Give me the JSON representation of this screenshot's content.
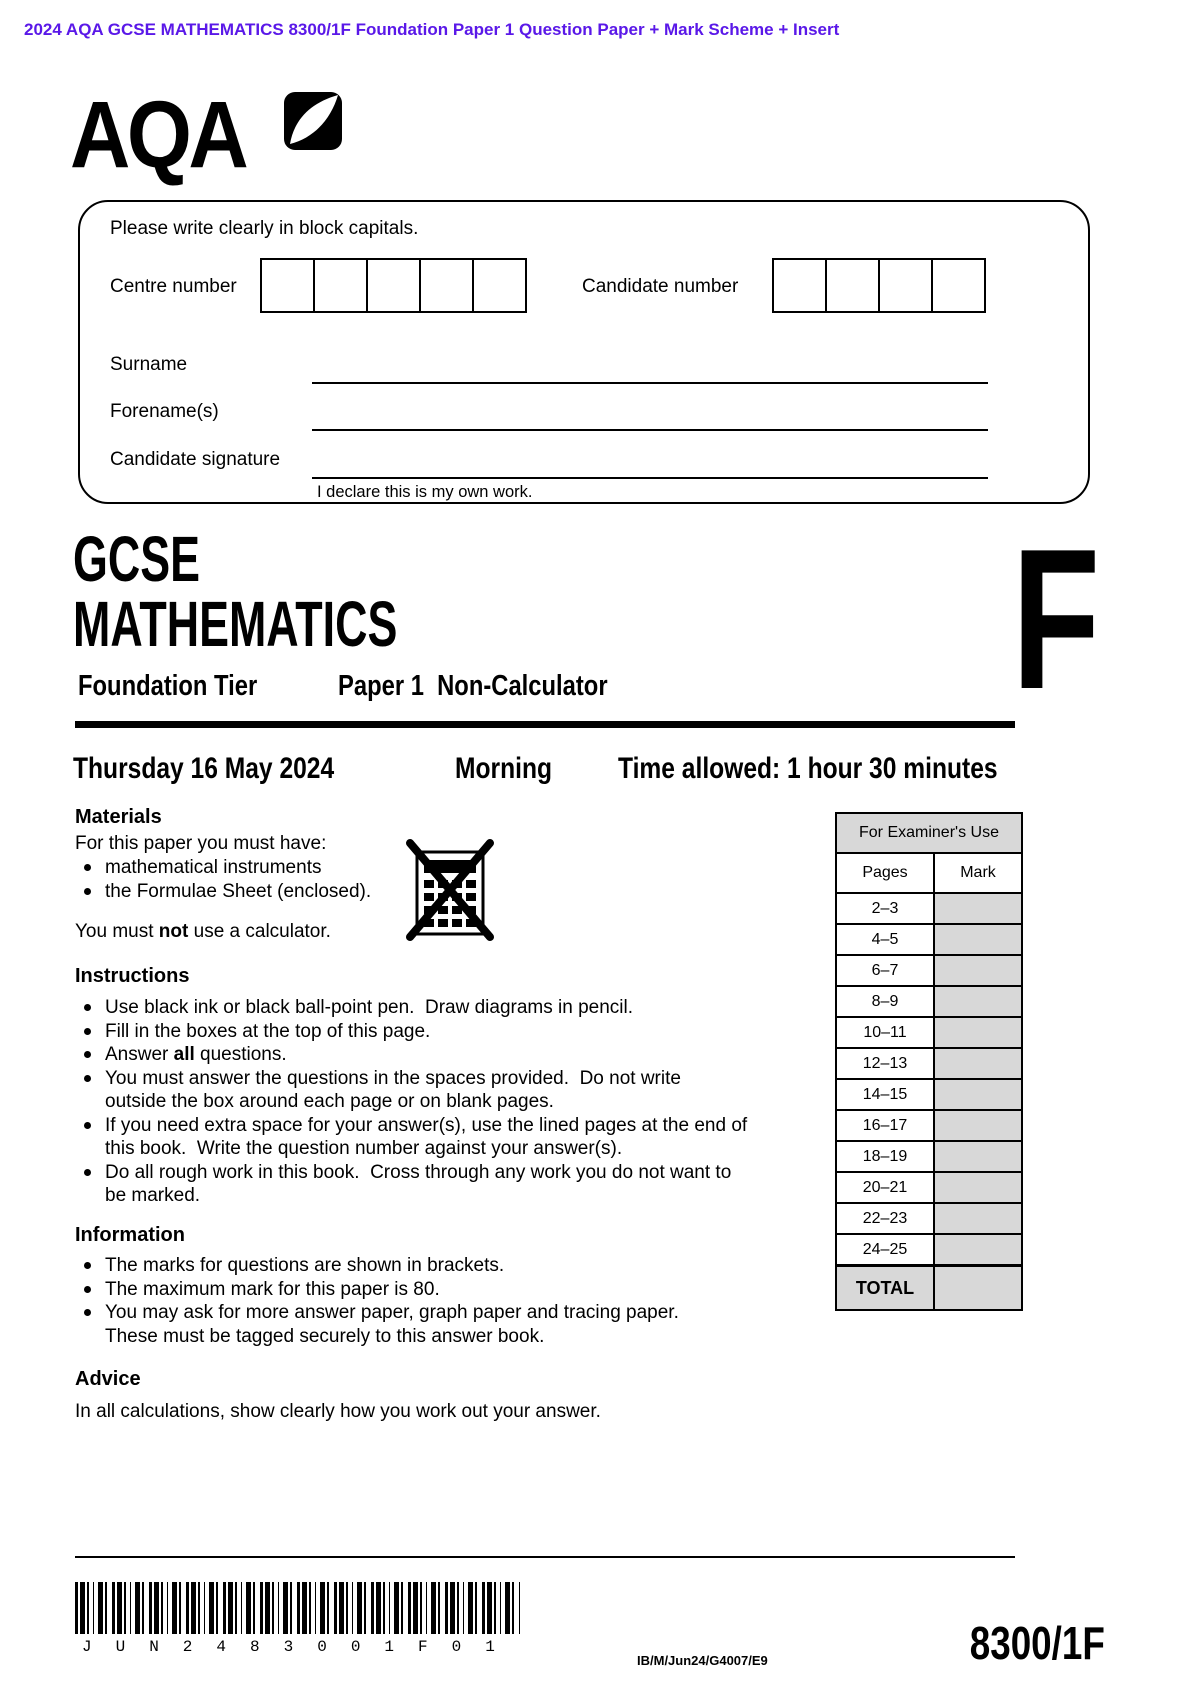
{
  "page_header": "2024 AQA GCSE MATHEMATICS 8300/1F Foundation Paper 1 Question Paper + Mark Scheme + Insert",
  "logo": {
    "text": "AQA"
  },
  "candidate_box": {
    "instruction": "Please write clearly in block capitals.",
    "centre_number_label": "Centre number",
    "candidate_number_label": "Candidate number",
    "surname_label": "Surname",
    "forenames_label": "Forename(s)",
    "signature_label": "Candidate signature",
    "declaration": "I declare this is my own work."
  },
  "title": {
    "qualification": "GCSE",
    "subject": "MATHEMATICS",
    "tier_label": "Foundation Tier",
    "paper_label": "Paper 1  Non-Calculator",
    "tier_letter": "F"
  },
  "session": {
    "date": "Thursday 16 May 2024",
    "time_of_day": "Morning",
    "time_allowed": "Time allowed: 1 hour 30 minutes"
  },
  "materials": {
    "heading": "Materials",
    "intro": "For this paper you must have:",
    "items": [
      "mathematical instruments",
      "the Formulae Sheet (enclosed)."
    ],
    "note_parts": {
      "pre": "You must ",
      "bold": "not",
      "post": " use a calculator."
    }
  },
  "instructions": {
    "heading": "Instructions",
    "items": [
      {
        "text": "Use black ink or black ball-point pen.  Draw diagrams in pencil."
      },
      {
        "text": "Fill in the boxes at the top of this page."
      },
      {
        "pre": "Answer ",
        "bold": "all",
        "post": " questions."
      },
      {
        "lines": [
          "You must answer the questions in the spaces provided.  Do not write",
          "outside the box around each page or on blank pages."
        ]
      },
      {
        "lines": [
          "If you need extra space for your answer(s), use the lined pages at the end of",
          "this book.  Write the question number against your answer(s)."
        ]
      },
      {
        "lines": [
          "Do all rough work in this book.  Cross through any work you do not want to",
          "be marked."
        ]
      }
    ]
  },
  "information": {
    "heading": "Information",
    "items": [
      {
        "text": "The marks for questions are shown in brackets."
      },
      {
        "text": "The maximum mark for this paper is 80."
      },
      {
        "lines": [
          "You may ask for more answer paper, graph paper and tracing paper.",
          "These must be tagged securely to this answer book."
        ]
      }
    ]
  },
  "advice": {
    "heading": "Advice",
    "text": "In all calculations, show clearly how you work out your answer."
  },
  "examiner_table": {
    "title": "For Examiner's Use",
    "col_headers": [
      "Pages",
      "Mark"
    ],
    "rows": [
      "2–3",
      "4–5",
      "6–7",
      "8–9",
      "10–11",
      "12–13",
      "14–15",
      "16–17",
      "18–19",
      "20–21",
      "22–23",
      "24–25"
    ],
    "total_label": "TOTAL"
  },
  "footer": {
    "barcode_text": "JUN2483001F01",
    "ref_code": "IB/M/Jun24/G4007/E9",
    "paper_code": "8300/1F"
  }
}
